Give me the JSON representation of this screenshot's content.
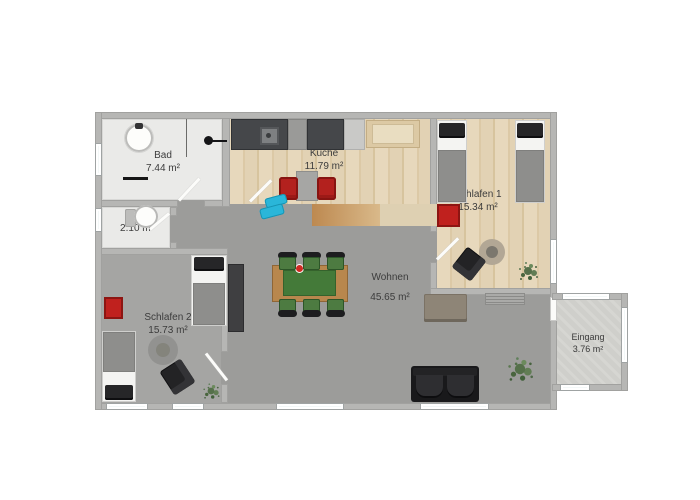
{
  "plan_title": "apartment-floor-plan",
  "rooms": {
    "bad": {
      "name": "Bad",
      "area": "7.44 m²"
    },
    "wc": {
      "name": "WC",
      "area": "2.10 m²"
    },
    "kueche": {
      "name": "Küche",
      "area": "11.79 m²"
    },
    "schlafen1": {
      "name": "Schlafen 1",
      "area": "15.34 m²"
    },
    "wohnen": {
      "name": "Wohnen",
      "area": "45.65 m²"
    },
    "schlafen2": {
      "name": "Schlafen 2",
      "area": "15.73 m²"
    },
    "eingang": {
      "name": "Eingang",
      "area": "3.76 m²"
    }
  },
  "colors": {
    "wall": "#b6b6b4",
    "floor_living_gray": "#9c9c9a",
    "floor_wood": "#e0d0b0",
    "floor_bath_white": "#eaeae8",
    "window_glass": "#f3f8f8",
    "accent_red": "#c0211e",
    "table_green": "#447a39",
    "sofa_black": "#19191b",
    "sofa_taupe": "#8e8577",
    "cyan_object": "#2ab6d9",
    "plant_green": "#55704a",
    "label_text": "#3c3c3c"
  },
  "furniture": {
    "bad": [
      "washbasin",
      "shower-divider",
      "wall-fixture",
      "radiator-bar",
      "door-leaf"
    ],
    "wc": [
      "toilet"
    ],
    "kueche": [
      "counter-with-sink",
      "dishwasher",
      "counter",
      "fridge",
      "wood-cabinet",
      "small-table",
      "red-chair",
      "red-chair",
      "door-leaf"
    ],
    "schlafen1": [
      "single-bed",
      "single-bed",
      "red-cabinet",
      "round-rug",
      "dark-chair",
      "plant",
      "door-leaf"
    ],
    "wohnen": [
      "dining-table-green",
      "six-dining-chairs",
      "sideboard",
      "taupe-sofa",
      "wall-shelf",
      "black-sofa",
      "plant",
      "cyan-object",
      "wardrobe-dark"
    ],
    "schlafen2": [
      "single-bed",
      "single-bed",
      "red-cabinet",
      "round-rug",
      "dark-chair",
      "plant",
      "door-leaf"
    ],
    "eingang": []
  }
}
